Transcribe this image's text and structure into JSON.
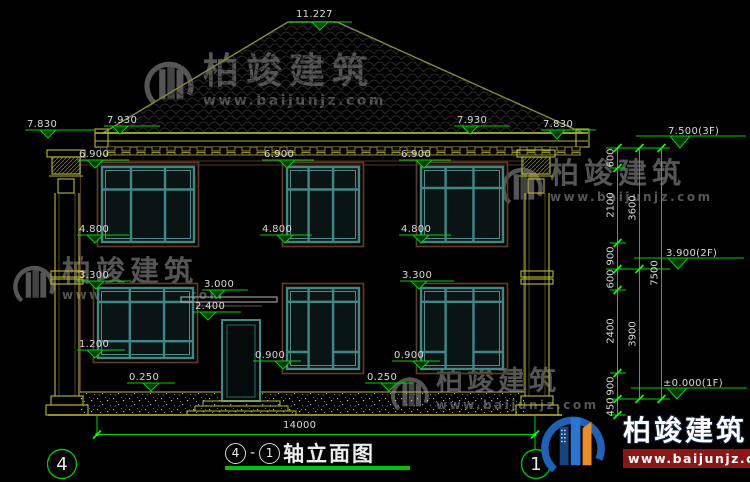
{
  "drawing": {
    "title": {
      "axis_start": "4",
      "separator": "-",
      "axis_end": "1",
      "name": "轴立面图"
    },
    "axis_bubbles": {
      "left": "4",
      "right": "1"
    },
    "overall_width_mm": "14000",
    "levels": {
      "ridge": "11.227",
      "eave_edge": "7.830",
      "eave_top": "7.930",
      "floor3": "7.500(3F)",
      "floor2": "3.900(2F)",
      "floor1": "±0.000(1F)",
      "win2_head": "6.900",
      "win2_sill": "4.800",
      "win1_head": "3.300",
      "canopy": "3.000",
      "door_head": "2.400",
      "sill_left": "1.200",
      "sill_std": "0.900",
      "plinth": "0.250"
    },
    "chain": {
      "seg_600": "600",
      "seg_2100": "2100",
      "seg_900": "900",
      "seg_2400": "2400",
      "seg_450": "450",
      "story_upper": "3600",
      "story_lower": "3900",
      "total": "7500"
    }
  },
  "watermark": {
    "brand": "柏竣建筑",
    "url": "www.baijunjz.com"
  },
  "logo": {
    "brand": "柏竣建筑",
    "url": "www.baijunjz.com"
  },
  "colors": {
    "dim_green": "#00d400",
    "bright_green": "#00ff00",
    "line_yellow": "#b8b832",
    "roof_olive": "#8a8a3c",
    "window_teal": "#3e8886",
    "trim_brown": "#5e3a2a",
    "logo_blue": "#1e62b8",
    "logo_orange": "#f08c1e",
    "logo_red_bar": "#8c1616"
  }
}
